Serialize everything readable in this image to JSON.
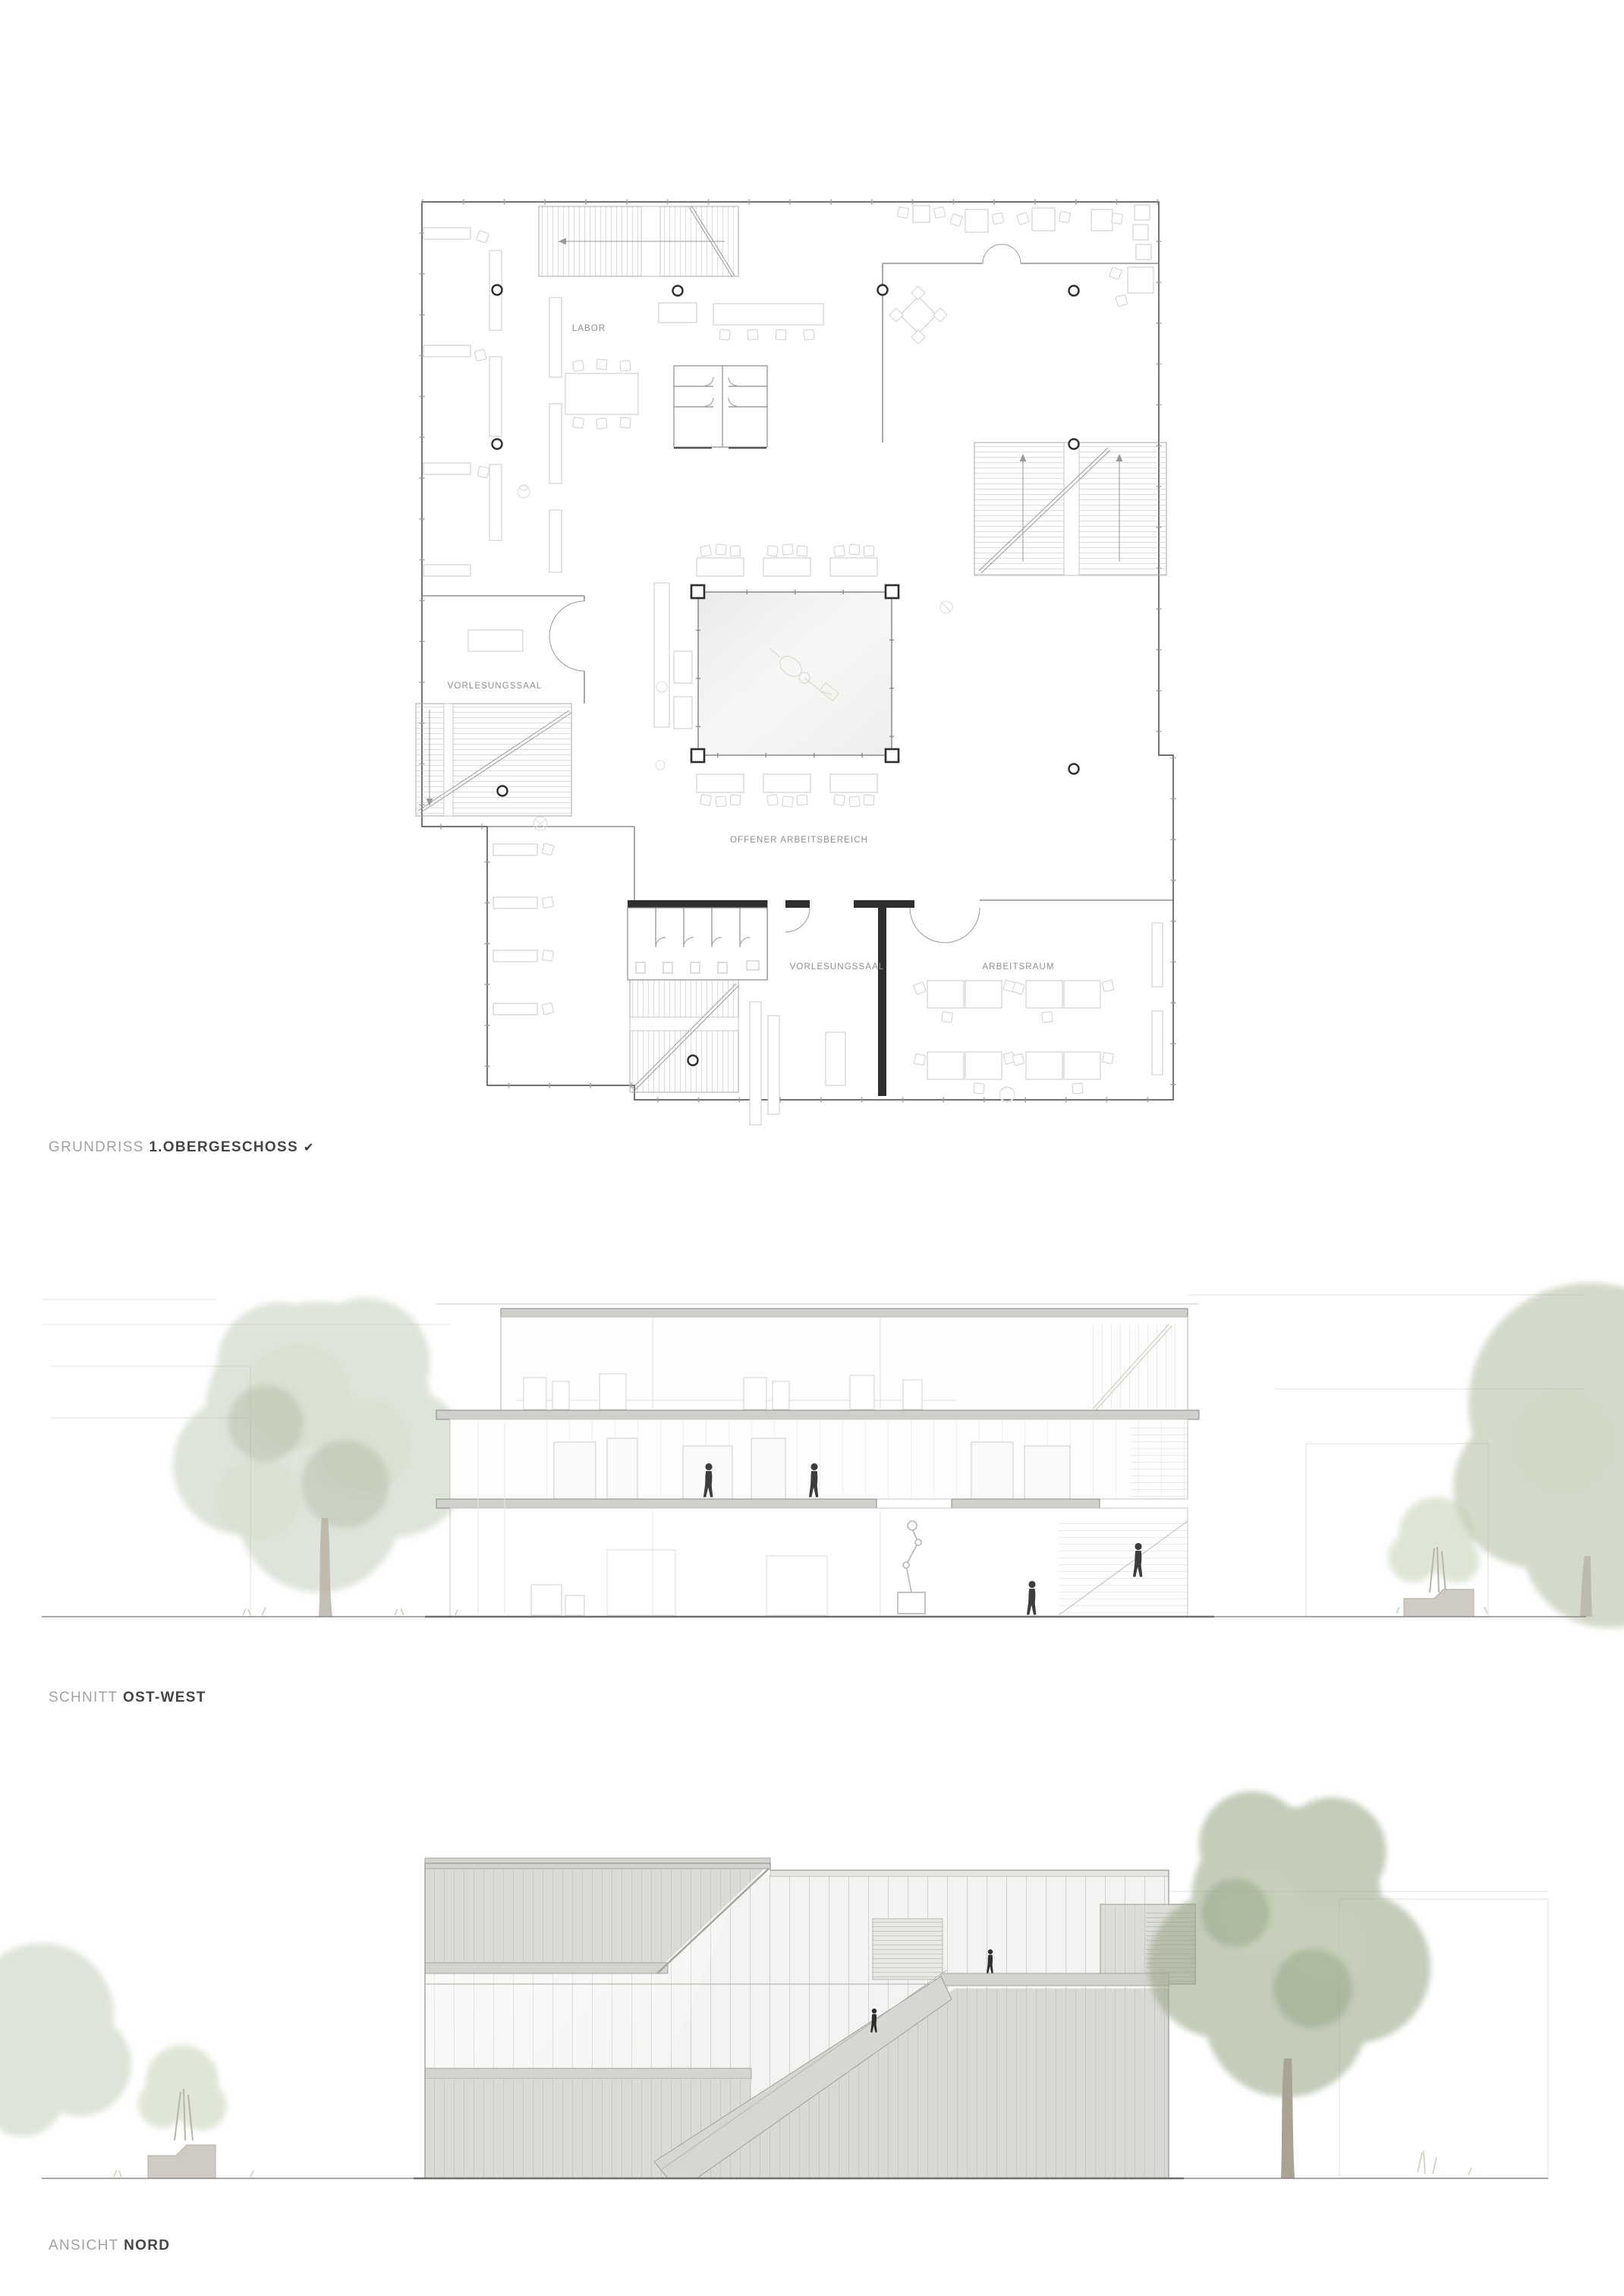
{
  "plan": {
    "caption_prefix": "GRUNDRISS",
    "caption_title": "1.OBERGESCHOSS",
    "caption_marker": "✔",
    "labels": {
      "labor": "LABOR",
      "vorlesungssaal_left": "VORLESUNGSSAAL",
      "offener_arbeitsbereich": "OFFENER ARBEITSBEREICH",
      "vorlesungssaal_bottom": "VORLESUNGSSAAL",
      "arbeitsraum": "ARBEITSRAUM"
    }
  },
  "section": {
    "caption_prefix": "SCHNITT",
    "caption_title": "OST-WEST"
  },
  "elevation": {
    "caption_prefix": "ANSICHT",
    "caption_title": "NORD"
  },
  "colors": {
    "wall": "#5f5f5f",
    "thin_line": "#c9c9c7",
    "room_label": "#8f8f8f",
    "caption_prefix": "#a2a2a2",
    "caption_title": "#454545",
    "concrete_band": "#d3d3cf",
    "glass_light": "#f3f3f1",
    "glass_shaded": "#dadad7",
    "tree_green": "#a3b193",
    "figure": "#3d3d3d"
  }
}
